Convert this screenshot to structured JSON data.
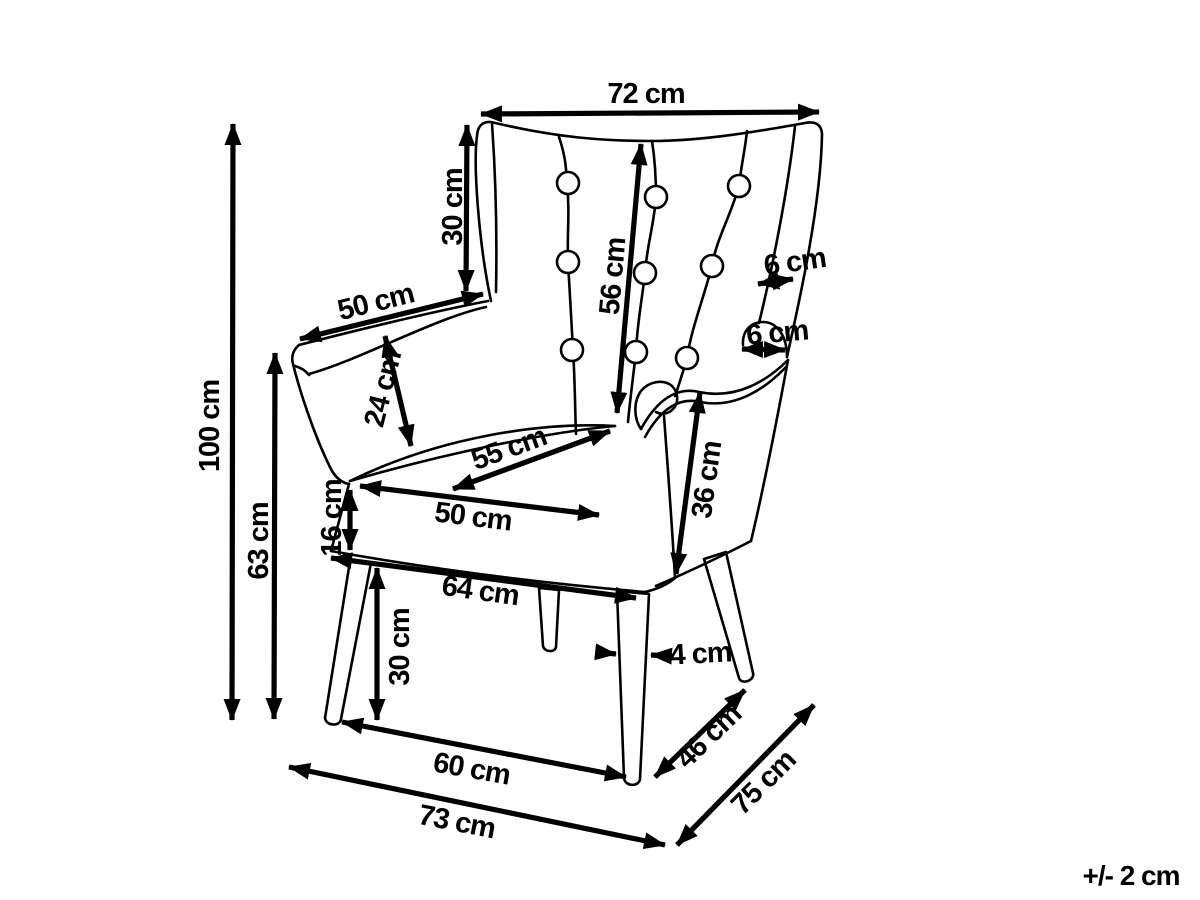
{
  "diagram": {
    "subject": "wingback-armchair-dimension-drawing",
    "line_color": "#000000",
    "background_color": "#ffffff",
    "tolerance": "+/- 2 cm",
    "dims": {
      "top_width": "72 cm",
      "back_top_height": "30 cm",
      "backrest_diagonal": "56 cm",
      "overall_height": "100 cm",
      "back_to_floor": "63 cm",
      "armrest_length": "50 cm",
      "armrest_height": "24 cm",
      "wing_width": "6 cm",
      "armrest_roll_width": "6 cm",
      "seat_depth": "55 cm",
      "seat_width": "50 cm",
      "seat_thickness": "16 cm",
      "seat_base_width": "64 cm",
      "side_panel_height": "36 cm",
      "leg_height": "30 cm",
      "leg_thickness": "4 cm",
      "leg_span_depth": "46 cm",
      "base_front_width": "60 cm",
      "overall_width": "73 cm",
      "overall_depth": "75 cm"
    }
  }
}
